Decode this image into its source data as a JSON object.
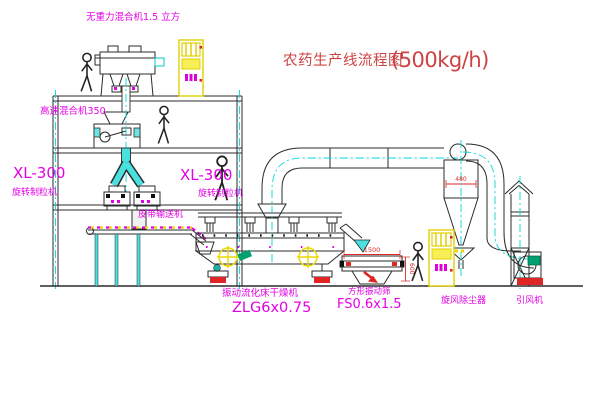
{
  "title": {
    "name": "农药生产线流程图",
    "capacity": "(500kg/h)"
  },
  "labels": {
    "gravity_mixer": "无重力混合机1.5 立方",
    "high_speed_mixer": "高速混合机350",
    "granulator_left": {
      "model": "XL-300",
      "name": "旋转制粒机"
    },
    "granulator_center": {
      "model": "XL-300",
      "name": "旋转制粒机"
    },
    "belt_conveyor": "皮带输送机",
    "dryer": {
      "name": "振动流化床干燥机",
      "model": "ZLG6x0.75"
    },
    "sieve": {
      "name": "方形振动筛",
      "model": "FS0.6x1.5"
    },
    "cyclone": "旋风除尘器",
    "fan": "引风机"
  },
  "dimensions": {
    "cyclone_diameter": "480",
    "sieve_length": "1500",
    "sieve_width": "600"
  },
  "colors": {
    "title_red": "#cd4343",
    "label_magenta": "#e400e4",
    "centerline_cyan": "#00d8d8",
    "cabinet_yellow": "#e8d800",
    "dimension_red": "#e02525",
    "line_dark": "#2b2b2b"
  }
}
